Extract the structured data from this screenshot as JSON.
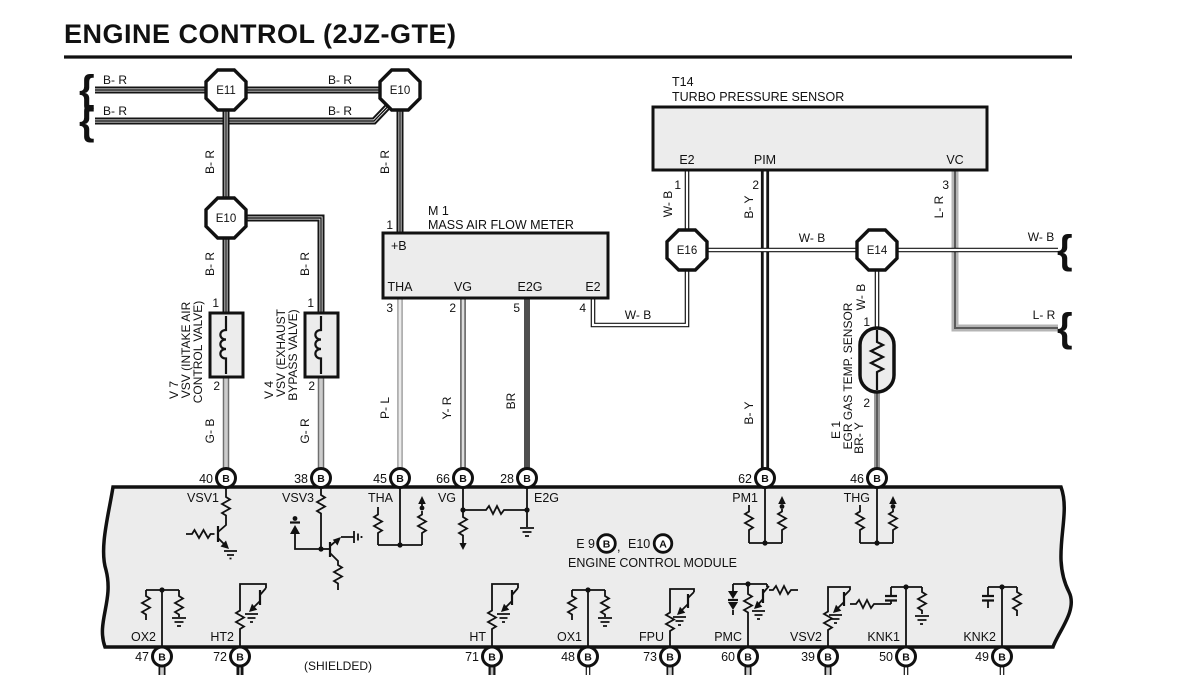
{
  "title": "ENGINE CONTROL (2JZ-GTE)",
  "wire_colors": {
    "b_r": "B- R",
    "g_b": "G- B",
    "g_r": "G- R",
    "p_l": "P- L",
    "y_r": "Y- R",
    "br": "BR",
    "w_b": "W- B",
    "b_y": "B- Y",
    "l_r": "L- R",
    "br_y": "BR- Y"
  },
  "junctions": {
    "e11": "E11",
    "e10": "E10",
    "e16": "E16",
    "e14": "E14"
  },
  "pin_numbers": {
    "n1": "1",
    "n2": "2",
    "n3": "3",
    "n4": "4",
    "n5": "5"
  },
  "components": {
    "maf": {
      "id": "M 1",
      "name": "MASS AIR FLOW METER",
      "pin_b": "+B",
      "pin_tha": "THA",
      "pin_vg": "VG",
      "pin_e2g": "E2G",
      "pin_e2": "E2"
    },
    "turbo": {
      "id": "T14",
      "name": "TURBO PRESSURE SENSOR",
      "pin_e2": "E2",
      "pin_pim": "PIM",
      "pin_vc": "VC"
    },
    "vsv_intake": {
      "id": "V 7",
      "name1": "VSV (INTAKE AIR",
      "name2": "CONTROL VALVE)"
    },
    "vsv_exhaust": {
      "id": "V 4",
      "name1": "VSV (EXHAUST",
      "name2": "BYPASS VALVE)"
    },
    "egr": {
      "id": "E 1",
      "name": "EGR GAS TEMP. SENSOR"
    }
  },
  "ecm": {
    "ref_note": {
      "part1": "E 9",
      "conn1": "B",
      "comma": ",",
      "part2": "E10",
      "conn2": "A"
    },
    "name": "ENGINE CONTROL MODULE",
    "shielded_note": "(SHIELDED)",
    "top_pins": [
      {
        "num": "40",
        "conn": "B",
        "name": "VSV1"
      },
      {
        "num": "38",
        "conn": "B",
        "name": "VSV3"
      },
      {
        "num": "45",
        "conn": "B",
        "name": "THA"
      },
      {
        "num": "66",
        "conn": "B",
        "name": "VG"
      },
      {
        "num": "28",
        "conn": "B",
        "name": "E2G"
      },
      {
        "num": "62",
        "conn": "B",
        "name": "PM1"
      },
      {
        "num": "46",
        "conn": "B",
        "name": "THG"
      }
    ],
    "bottom_pins": [
      {
        "num": "47",
        "conn": "B",
        "name": "OX2"
      },
      {
        "num": "72",
        "conn": "B",
        "name": "HT2"
      },
      {
        "num": "71",
        "conn": "B",
        "name": "HT"
      },
      {
        "num": "48",
        "conn": "B",
        "name": "OX1"
      },
      {
        "num": "73",
        "conn": "B",
        "name": "FPU"
      },
      {
        "num": "60",
        "conn": "B",
        "name": "PMC"
      },
      {
        "num": "39",
        "conn": "B",
        "name": "VSV2"
      },
      {
        "num": "50",
        "conn": "B",
        "name": "KNK1"
      },
      {
        "num": "49",
        "conn": "B",
        "name": "KNK2"
      }
    ]
  }
}
